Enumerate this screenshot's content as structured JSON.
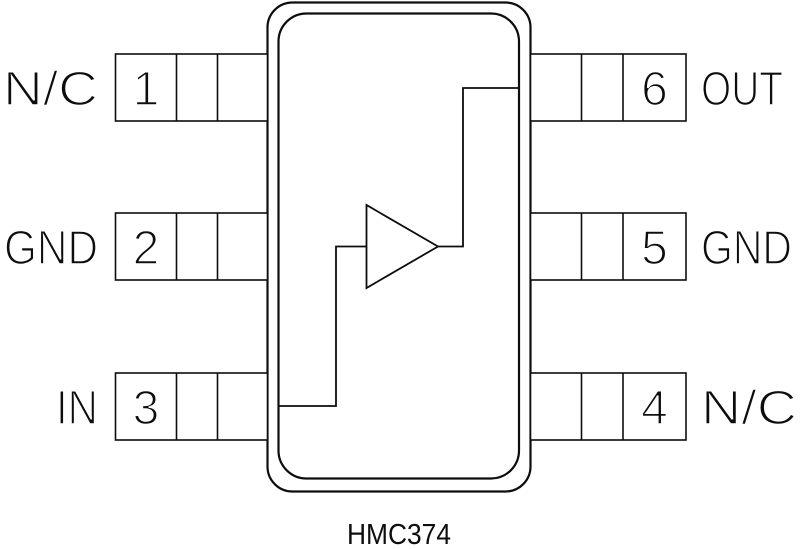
{
  "diagram": {
    "part_number": "HMC374",
    "symbol_name": "amplifier",
    "colors": {
      "line": "#0d0d0d",
      "background": "#ffffff"
    },
    "pins": {
      "left": [
        {
          "number": "1",
          "label": "N/C"
        },
        {
          "number": "2",
          "label": "GND"
        },
        {
          "number": "3",
          "label": "IN"
        }
      ],
      "right": [
        {
          "number": "6",
          "label": "OUT"
        },
        {
          "number": "5",
          "label": "GND"
        },
        {
          "number": "4",
          "label": "N/C"
        }
      ]
    }
  }
}
